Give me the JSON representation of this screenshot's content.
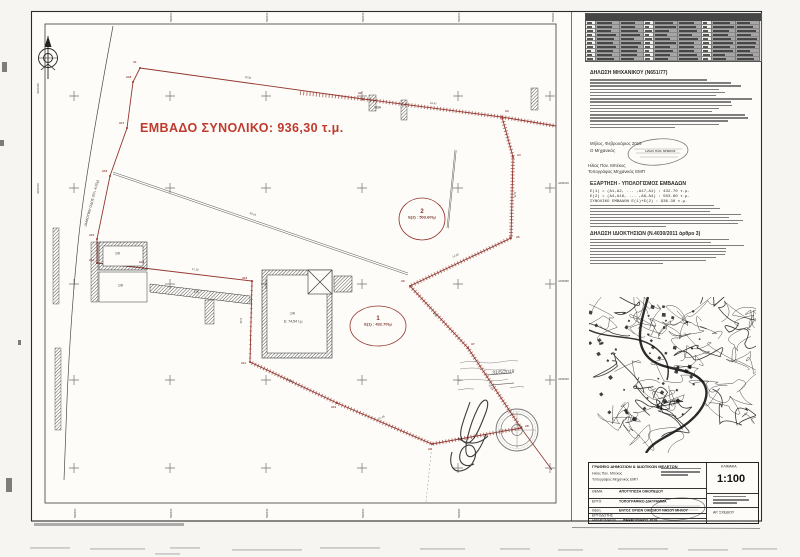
{
  "plan": {
    "total_area_label": "ΕΜΒΑΔΟ ΣΥΝΟΛΙΚΟ: 936,30 τ.μ.",
    "accent_red": "#93362e",
    "areas": [
      {
        "num": "1",
        "label": "Ε(1) : 432.70τμ"
      },
      {
        "num": "2",
        "label": "Ε(2) : 503.60τμ"
      }
    ],
    "road_label": "ΔΗΜΟΤΙΚΗ ΟΔΟΣ (ΠΛ. 4,00μ)",
    "building_labels": [
      "1/Κ",
      "1/Κ",
      "1/Κ",
      "1/Κ"
    ],
    "main_building_area": "Ε: 74,54 τ.μ.",
    "misc_label": "ΥΒΑ",
    "handwritten_date": "31/5/2019",
    "vertex_labels": [
      {
        "t": "Α1",
        "x": 133,
        "y": 61
      },
      {
        "t": "Α2",
        "x": 358,
        "y": 92
      },
      {
        "t": "Α3",
        "x": 505,
        "y": 110
      },
      {
        "t": "Α4",
        "x": 517,
        "y": 154
      },
      {
        "t": "Α5",
        "x": 516,
        "y": 236
      },
      {
        "t": "Α6",
        "x": 401,
        "y": 280
      },
      {
        "t": "Α7",
        "x": 471,
        "y": 343
      },
      {
        "t": "Α8",
        "x": 525,
        "y": 425
      },
      {
        "t": "Α9",
        "x": 428,
        "y": 448
      },
      {
        "t": "Α10",
        "x": 331,
        "y": 406
      },
      {
        "t": "Α11",
        "x": 241,
        "y": 362
      },
      {
        "t": "Α12",
        "x": 242,
        "y": 277
      },
      {
        "t": "Α13",
        "x": 139,
        "y": 261
      },
      {
        "t": "Α14",
        "x": 89,
        "y": 259
      },
      {
        "t": "Α15",
        "x": 89,
        "y": 234
      },
      {
        "t": "Α16",
        "x": 102,
        "y": 170
      },
      {
        "t": "Α17",
        "x": 119,
        "y": 122
      },
      {
        "t": "Α18",
        "x": 126,
        "y": 76
      }
    ],
    "measure_labels": [
      {
        "t": "25.91",
        "x": 245,
        "y": 76,
        "r": 8
      },
      {
        "t": "18.42",
        "x": 430,
        "y": 102,
        "r": 6
      },
      {
        "t": "8.76",
        "x": 516,
        "y": 192,
        "r": 90
      },
      {
        "t": "14.28",
        "x": 452,
        "y": 256,
        "r": -24
      },
      {
        "t": "9.05",
        "x": 434,
        "y": 312,
        "r": 49
      },
      {
        "t": "11.64",
        "x": 490,
        "y": 384,
        "r": 56
      },
      {
        "t": "21.46",
        "x": 378,
        "y": 418,
        "r": -25
      },
      {
        "t": "13.85",
        "x": 287,
        "y": 378,
        "r": 25
      },
      {
        "t": "9.30",
        "x": 242,
        "y": 318,
        "r": 90
      },
      {
        "t": "12.10",
        "x": 192,
        "y": 268,
        "r": 7
      },
      {
        "t": "30.15",
        "x": 250,
        "y": 212,
        "r": 19
      }
    ],
    "grid": {
      "top": [
        "598400",
        "598420",
        "598440",
        "598460",
        "598480"
      ],
      "bottom": [
        "598400",
        "598420",
        "598440",
        "598460",
        "598480"
      ],
      "left": [
        "4406080",
        "4406030"
      ],
      "right": [
        "4406030",
        "4405980",
        "4405930"
      ]
    }
  },
  "coordinate_table": {
    "rows": 10,
    "groups": 3,
    "columns_per_group": [
      "Σ",
      "Χ",
      "Υ"
    ]
  },
  "declarations": [
    {
      "title": "ΔΗΛΩΣΗ ΜΗΧΑΝΙΚΟΥ (Ν651/77)",
      "lines": 16
    },
    {
      "title": "ΕΞΑΡΤΗΣΗ - ΥΠΟΛΟΓΙΣΜΟΣ ΕΜΒΑΔΩΝ",
      "visible_lines": [
        "Ε(1) = (Α1,Α2, ... ,Α17,Α1) : 432.70 τ.μ.",
        "Ε(2) = (Α4,Α18, ... ,Α8,Α4) : 503.60 τ.μ.",
        "ΣΥΝΟΛΙΚΟ ΕΜΒΑΔΟΝ Ε(1)+Ε(2) : 936.30 τ.μ."
      ],
      "lines": 8
    },
    {
      "title": "ΔΗΛΩΣΗ ΙΔΙΟΚΤΗΣΙΩΝ (Ν.4030/2011 άρθρο 3)",
      "lines": 9
    }
  ],
  "signoff": {
    "place_date": "Μήλος, Φεβρουάριος 2019",
    "role": "Ο Μηχανικός",
    "name": "Ηλίας Παν. Μπέκος",
    "title": "Τοπογράφος Μηχανικός ΕΜΠ",
    "stamp_name": "ΗΛΙΑΣ ΠΑΝ. ΜΠΕΚΟΣ"
  },
  "title_block": {
    "office": "ΓΡΑΦΕΙΟ ΔΗΜΟΣΙΩΝ & ΙΔΙΩΤΙΚΩΝ ΜΕΛΕΤΩΝ",
    "name": "Ηλίας Παν. Μπέκος",
    "profession": "Τοπογράφος Μηχανικός ΕΜΠ",
    "rows": [
      {
        "label": "ΘΕΜΑ",
        "value": "ΑΠΟΤΥΠΩΣΗ ΟΙΚΟΠΕΔΟΥ"
      },
      {
        "label": "ΕΡΓΟ",
        "value": "ΤΟΠΟΓΡΑΦΙΚΟ ΔΙΑΓΡΑΜΜΑ"
      },
      {
        "label": "Θέση",
        "value": "ΕΝΤΟΣ ΟΡΙΩΝ ΟΙΚΙΣΜΟΥ ΝΗΣΟΥ ΜΗΛΟΥ"
      },
      {
        "label": "ΕΡΓΟΔΟΤΗΣ",
        "value": ""
      },
      {
        "label": "ΗΜΕΡΟΜΗΝΙΑ",
        "value": "ΦΕΒΡΟΥΑΡΙΟΣ 2019"
      }
    ],
    "scale_label": "ΚΛΙΜΑΚΑ",
    "scale_value": "1:100",
    "drawing_no_label": "ΑΡ. ΣΧΕΔΙΟΥ"
  }
}
